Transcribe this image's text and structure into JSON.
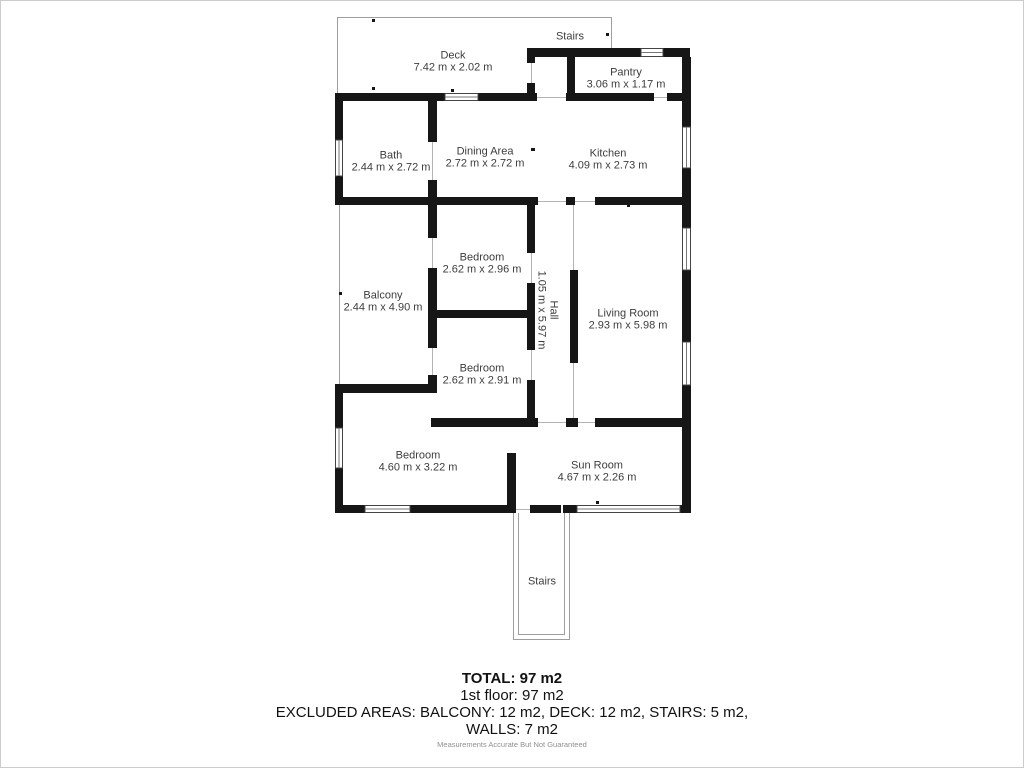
{
  "plan": {
    "rooms": [
      {
        "id": "deck",
        "name": "Deck",
        "dims": "7.42 m x 2.02 m"
      },
      {
        "id": "stairs-top",
        "name": "Stairs",
        "dims": ""
      },
      {
        "id": "pantry",
        "name": "Pantry",
        "dims": "3.06 m x 1.17 m"
      },
      {
        "id": "bath",
        "name": "Bath",
        "dims": "2.44 m x 2.72 m"
      },
      {
        "id": "dining-area",
        "name": "Dining Area",
        "dims": "2.72 m x 2.72 m"
      },
      {
        "id": "kitchen",
        "name": "Kitchen",
        "dims": "4.09 m x 2.73 m"
      },
      {
        "id": "balcony",
        "name": "Balcony",
        "dims": "2.44 m x 4.90 m"
      },
      {
        "id": "bedroom-1",
        "name": "Bedroom",
        "dims": "2.62 m x 2.96 m"
      },
      {
        "id": "hall",
        "name": "Hall",
        "dims": "1.05 m x 5.97 m"
      },
      {
        "id": "bedroom-2",
        "name": "Bedroom",
        "dims": "2.62 m x 2.91 m"
      },
      {
        "id": "living-room",
        "name": "Living Room",
        "dims": "2.93 m x 5.98 m"
      },
      {
        "id": "bedroom-3",
        "name": "Bedroom",
        "dims": "4.60 m x 3.22 m"
      },
      {
        "id": "sun-room",
        "name": "Sun Room",
        "dims": "4.67 m x 2.26 m"
      },
      {
        "id": "stairs-bottom",
        "name": "Stairs",
        "dims": ""
      }
    ],
    "wall_color": "#161616",
    "window_border_color": "#444444",
    "thin_line_color": "#9e9e9e"
  },
  "summary": {
    "total": "TOTAL: 97 m2",
    "floor": "1st floor: 97 m2",
    "excluded_line1": "EXCLUDED AREAS: BALCONY: 12 m2, DECK: 12 m2, STAIRS: 5 m2,",
    "excluded_line2": "WALLS: 7 m2",
    "disclaimer": "Measurements Accurate But Not Guaranteed"
  }
}
